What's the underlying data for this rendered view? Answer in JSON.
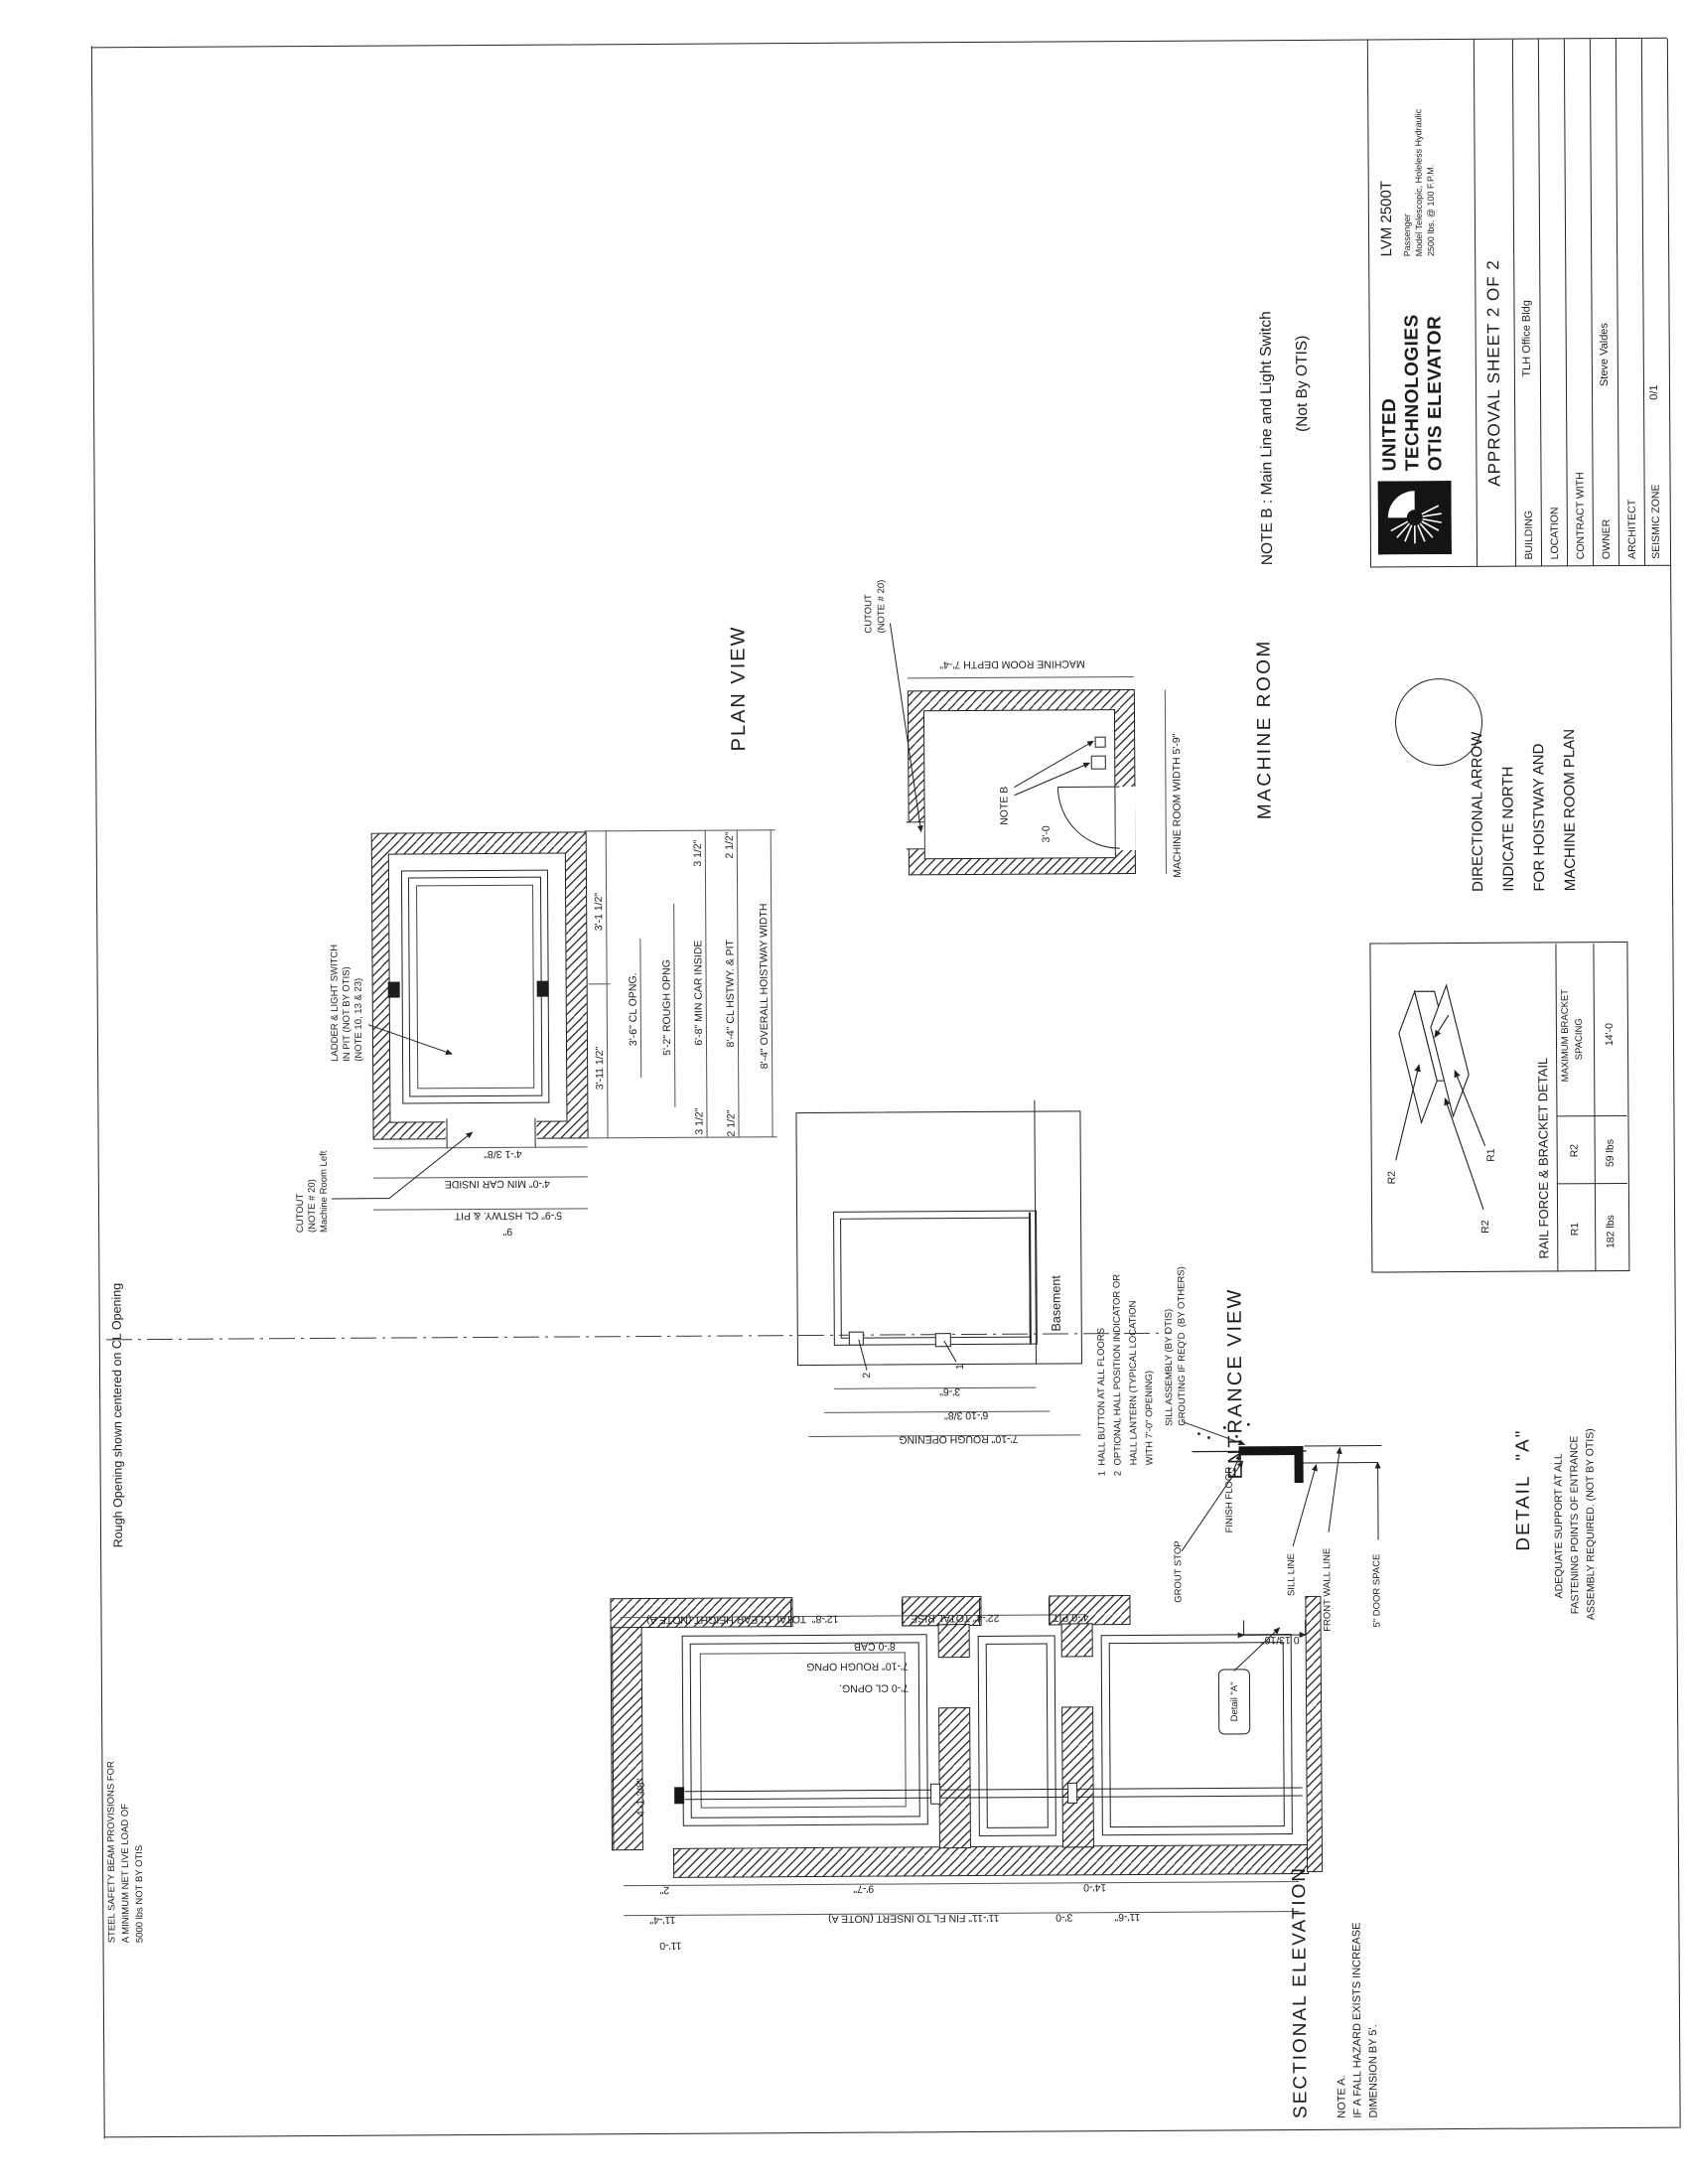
{
  "sheet": {
    "rough_opening_note": "Rough Opening shown centered on CL Opening",
    "beam_note": [
      "STEEL SAFETY BEAM PROVISIONS FOR",
      "A MINIMUM NET LIVE LOAD OF",
      "5000 lbs NOT BY OTIS"
    ]
  },
  "plan_view": {
    "title": "PLAN VIEW",
    "ladder_note": [
      "LADDER & LIGHT SWITCH",
      "IN PIT (NOT BY OTIS)",
      "(NOTE 10, 13 & 23)"
    ],
    "cutout_note": [
      "CUTOUT",
      "(NOTE # 20)",
      "Machine Room Left"
    ],
    "dim_rows": [
      "3'-11 1/2\"",
      "3'-1 1/2\"",
      "3'-6\" CL OPNG.",
      "5'-2\" ROUGH OPNG",
      "3 1/2\"",
      "6'-8\" MIN CAR INSIDE",
      "3 1/2\"",
      "2 1/2\"",
      "8'-4\" CL HSTWY. & PIT",
      "2 1/2\"",
      "8'-4\" OVERALL HOISTWAY WIDTH"
    ],
    "dim_cols": [
      "4'-1 3/8\"",
      "4'-0\" MIN CAR INSIDE",
      "5'-9\" CL HSTWY. & PIT"
    ],
    "dim_small": "9\""
  },
  "machine_room": {
    "title": "MACHINE ROOM",
    "cutout_note": [
      "CUTOUT",
      "(NOTE # 20)"
    ],
    "note_b_label": "NOTE B",
    "door_dim": "3'-0",
    "width_dim": "MACHINE ROOM WIDTH 5'-9\"",
    "depth_dim": "MACHINE ROOM DEPTH 7'-4\""
  },
  "direction_note": {
    "lines": [
      "DIRECTIONAL ARROW",
      "INDICATE NORTH",
      "FOR HOISTWAY AND",
      "MACHINE ROOM PLAN"
    ]
  },
  "rail_detail": {
    "title": "RAIL FORCE & BRACKET DETAIL",
    "label_r2_top": "R2",
    "label_r2_left": "R2",
    "label_r1": "R1",
    "header_r1": "R1",
    "header_r2": "R2",
    "header_spacing": [
      "MAXIMUM BRACKET",
      "SPACING"
    ],
    "value_r1": "182 lbs",
    "value_r2": "59 lbs",
    "value_spacing": "14'-0"
  },
  "entrance_view": {
    "title": "ENTRANCE VIEW",
    "floor_label": "Basement",
    "notes": [
      "1  HALL BUTTON AT ALL FLOORS",
      "2  OPTIONAL HALL POSITION INDICATOR OR",
      "    HALL LANTERN (TYPICAL LOCATION",
      "    WITH 7'-0\" OPENING)"
    ],
    "callout_2": "2",
    "callout_1": "1",
    "dims": [
      "3'-6\"",
      "6'-10 3/8\"",
      "7'-10\" ROUGH OPENING"
    ]
  },
  "detail_a": {
    "title": "DETAIL  \"A\"",
    "label_sill_assembly": [
      "SILL ASSEMBLY (BY OTIS)",
      "GROUTING IF REQ'D  (BY OTHERS)"
    ],
    "label_finish_floor": "FINISH FLOOR",
    "label_grout_stop": "GROUT STOP",
    "label_sill_line": "SILL LINE",
    "label_front_wall": "FRONT WALL LINE",
    "label_door_space": "5\" DOOR SPACE",
    "dim": "0 13/16\"",
    "note": [
      "ADEQUATE SUPPORT AT ALL",
      "FASTENING POINTS OF ENTRANCE",
      "ASSEMBLY REQUIRED. (NOT BY OTIS)"
    ]
  },
  "section": {
    "title": "SECTIONAL ELEVATION",
    "note_a": [
      "NOTE A.",
      "IF A FALL HAZARD EXISTS INCREASE",
      "DIMENSION BY 5'."
    ],
    "right_dims": [
      "12'-8\"  TOTAL CLEAR HEIGHT (NOTE A)",
      "22'-4\" TOTAL RISE",
      "4'-0 PIT",
      "8'-0 CAB",
      "7'-10\" ROUGH OPNG",
      "7'-0 CL OPNG."
    ],
    "left_dims": [
      "2\"",
      "9'-7\"",
      "14'-0",
      "11'-4\"",
      "11'-11\" FIN FL TO INSERT (NOTE A)",
      "3'-0",
      "11'-6\"",
      "11'-0"
    ],
    "top_dim": "4'-1 3/8\"",
    "detail_tag": "Detail \"A\""
  },
  "note_b": {
    "line1": "NOTE B : Main Line and Light Switch",
    "line2": "(Not By OTIS)"
  },
  "title_block": {
    "company": [
      "UNITED",
      "TECHNOLOGIES",
      "OTIS ELEVATOR"
    ],
    "model": "LVM 2500T",
    "model_sub": [
      "Passenger",
      "Model Telescopic, Holeless Hydraulic",
      "2500 lbs. @ 100 F.P.M."
    ],
    "sheet_title": "APPROVAL SHEET 2 OF 2",
    "rows": [
      {
        "label": "BUILDING",
        "value": "TLH Office Bldg"
      },
      {
        "label": "LOCATION",
        "value": ""
      },
      {
        "label": "CONTRACT WITH",
        "value": ""
      },
      {
        "label": "OWNER",
        "value": "Steve Valdes"
      },
      {
        "label": "ARCHITECT",
        "value": ""
      },
      {
        "label": "SEISMIC ZONE",
        "value": "0/1"
      }
    ]
  }
}
